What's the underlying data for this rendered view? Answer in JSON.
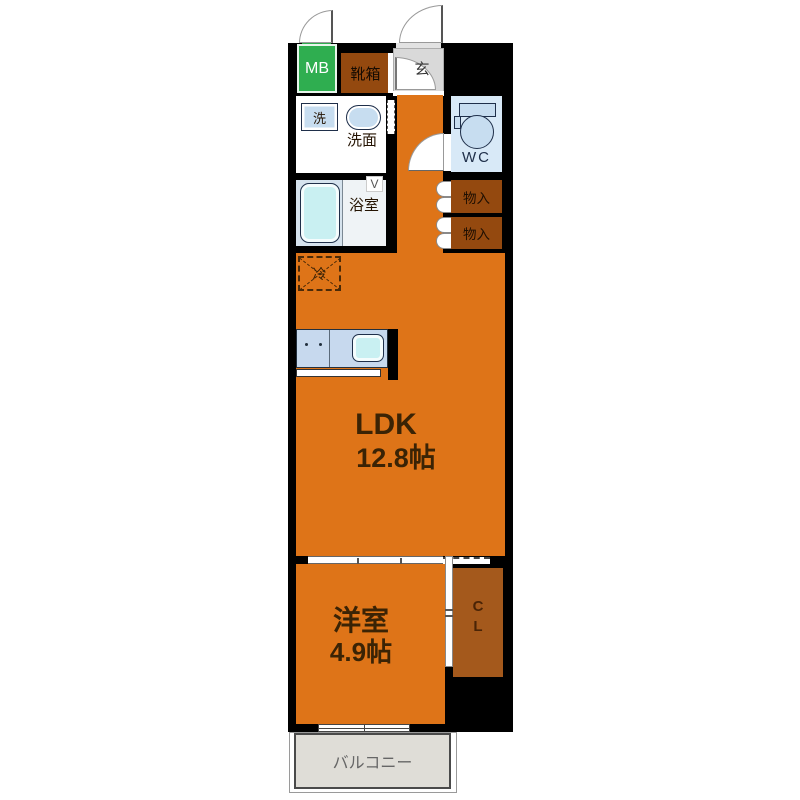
{
  "plan": {
    "meter_box": "MB",
    "shoe_box": "靴箱",
    "entrance": "玄",
    "washer": "洗",
    "washroom": "洗面",
    "toilet": "WC",
    "bathroom": "浴室",
    "bathroom_door_mark": "V",
    "storage_upper": "物入",
    "storage_lower": "物入",
    "refrigerator": "冷",
    "ldk_label": "LDK",
    "ldk_area": "12.8帖",
    "western_room_label": "洋室",
    "western_room_area": "4.9帖",
    "closet_line1": "C",
    "closet_line2": "L",
    "balcony": "バルコニー"
  },
  "colors": {
    "floor_orange": "#DE7418",
    "cabinet_brown": "#94490F",
    "closet_brown": "#A4591C",
    "mb_green": "#2FAE50",
    "entry_gray": "#D9D9D9",
    "fixture_blue": "#C7DDF0",
    "tub_cyan": "#C9F0F2",
    "balcony_gray": "#DFDDD7",
    "wall_black": "#000000"
  }
}
